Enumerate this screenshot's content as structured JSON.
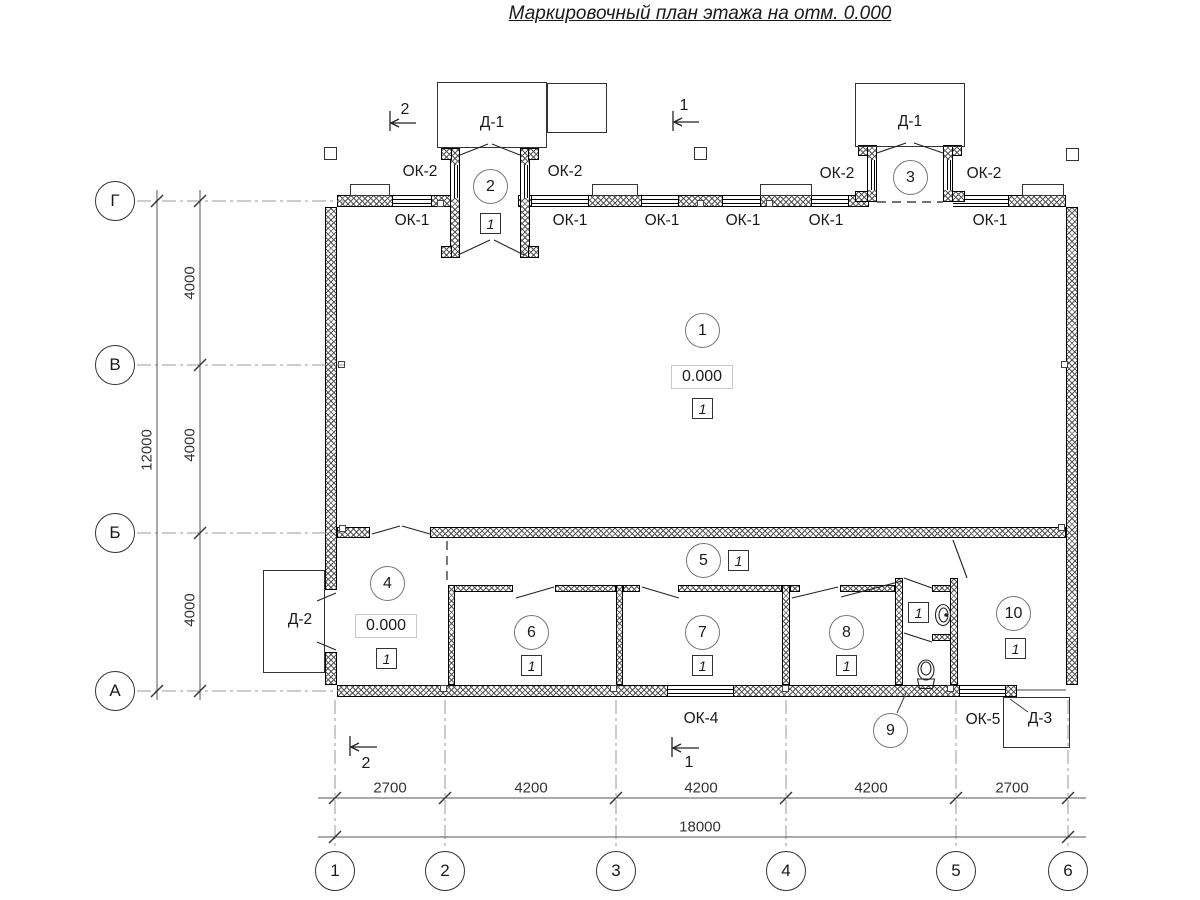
{
  "title": "Маркировочный план этажа на отм. 0.000",
  "axes": {
    "row_labels": [
      "Г",
      "В",
      "Б",
      "А"
    ],
    "col_labels": [
      "1",
      "2",
      "3",
      "4",
      "5",
      "6"
    ]
  },
  "dims": {
    "v": [
      "4000",
      "4000",
      "4000"
    ],
    "v_total": "12000",
    "h": [
      "2700",
      "4200",
      "4200",
      "4200",
      "2700"
    ],
    "h_total": "18000"
  },
  "rooms": [
    {
      "num": "1",
      "type": "1",
      "elev": "0.000"
    },
    {
      "num": "2",
      "type": "1"
    },
    {
      "num": "3"
    },
    {
      "num": "4",
      "type": "1",
      "elev": "0.000"
    },
    {
      "num": "5",
      "type": "1"
    },
    {
      "num": "6",
      "type": "1"
    },
    {
      "num": "7",
      "type": "1"
    },
    {
      "num": "8",
      "type": "1"
    },
    {
      "num": "9",
      "type": "1"
    },
    {
      "num": "10",
      "type": "1"
    }
  ],
  "doors": {
    "d1": "Д-1",
    "d2": "Д-2",
    "d3": "Д-3"
  },
  "windows": {
    "ok1": "ОК-1",
    "ok2": "ОК-2",
    "ok4": "ОК-4",
    "ok5": "ОК-5"
  },
  "sections": {
    "s1": "1",
    "s2": "2"
  }
}
